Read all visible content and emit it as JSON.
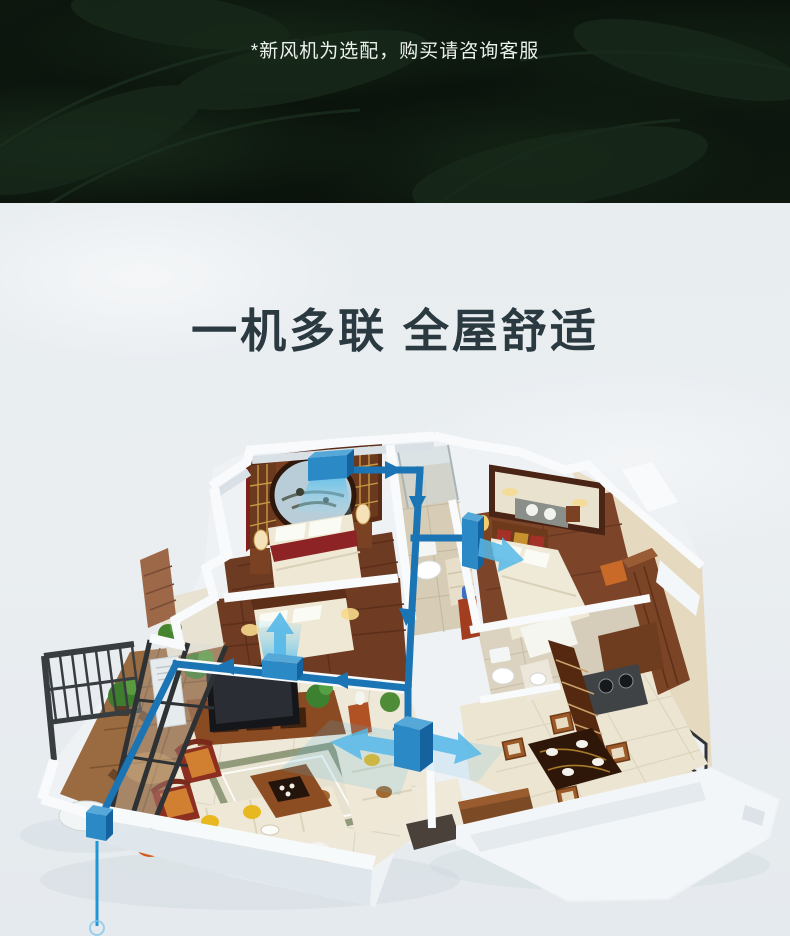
{
  "banner": {
    "note": "*新风机为选配，购买请咨询客服"
  },
  "hero": {
    "title": "一机多联 全屋舒适"
  },
  "colors": {
    "banner_bg": "#0b140d",
    "banner_text": "#edf1ed",
    "page_bg": "#e9edf0",
    "title": "#2b3940",
    "duct": "#1b74b4",
    "airflow": "#55b8e8"
  },
  "floorplan": {
    "airflow_outlets": [
      "bedroom-1-ceiling-outlet",
      "bedroom-2-wall-outlet",
      "master-bedroom-wall-outlet",
      "living-dining-branch-unit",
      "balcony-riser-unit"
    ]
  }
}
